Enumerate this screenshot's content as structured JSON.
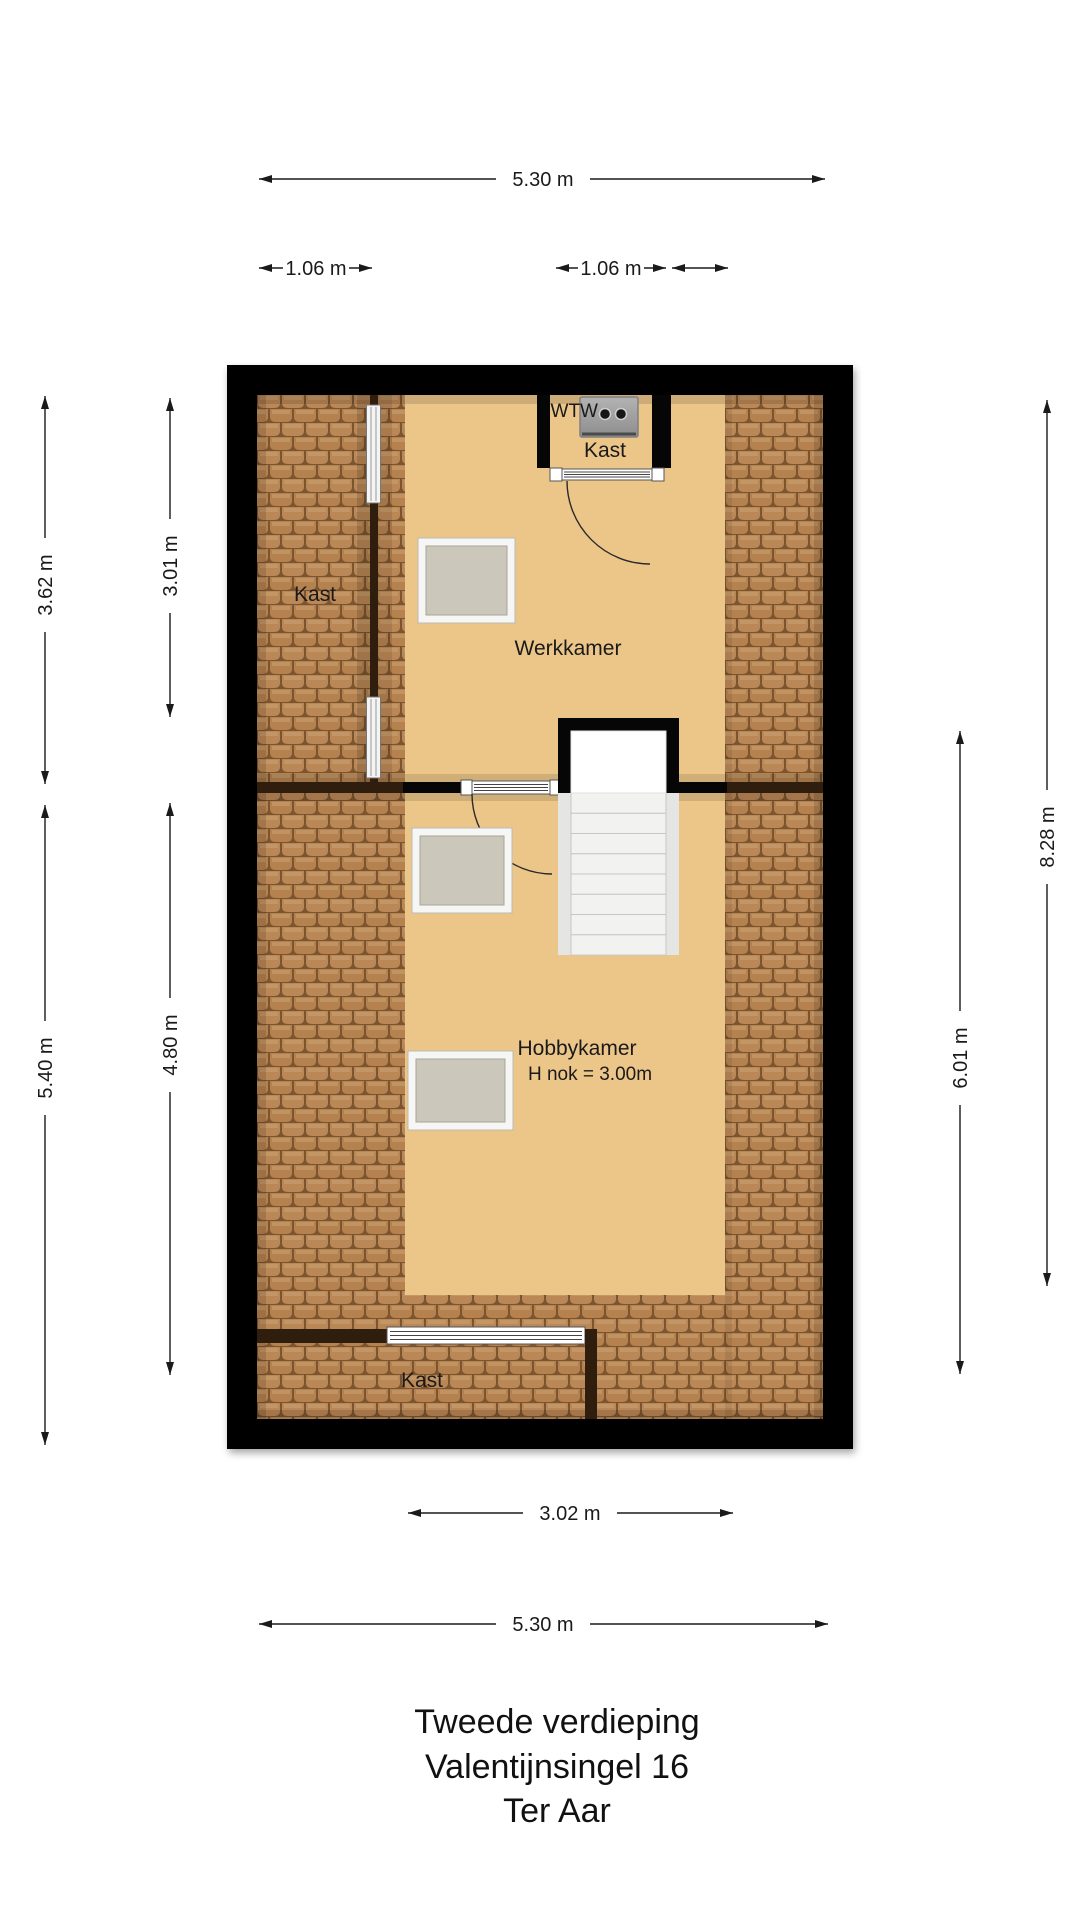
{
  "plan": {
    "rooms": {
      "kast_left": "Kast",
      "wtw": "WTW",
      "kast_top": "Kast",
      "werkkamer": "Werkkamer",
      "hobbykamer": "Hobbykamer",
      "hobbykamer_sub": "H nok = 3.00m",
      "kast_bottom": "Kast"
    },
    "dimensions": {
      "top_width": "5.30 m",
      "top_left_closet": "1.06 m",
      "top_mid_closet": "1.06 m",
      "left_upper_outer": "3.62 m",
      "left_upper_inner": "3.01 m",
      "left_lower_outer": "5.40 m",
      "left_lower_inner": "4.80 m",
      "right_full": "8.28 m",
      "right_lower": "6.01 m",
      "bottom_inner": "3.02 m",
      "bottom_width": "5.30 m"
    },
    "colors": {
      "wall": "#060606",
      "floor": "#ecc689",
      "roof_tile": "#ba8756",
      "tile_grout": "#7a5530",
      "wood_wall": "#2f1d0d",
      "window_fill": "#cbc7bb",
      "stair_tread": "#f2f2f0",
      "wtw_unit": "#a0a0a0"
    }
  },
  "title": {
    "line1": "Tweede verdieping",
    "line2": "Valentijnsingel 16",
    "line3": "Ter Aar"
  }
}
